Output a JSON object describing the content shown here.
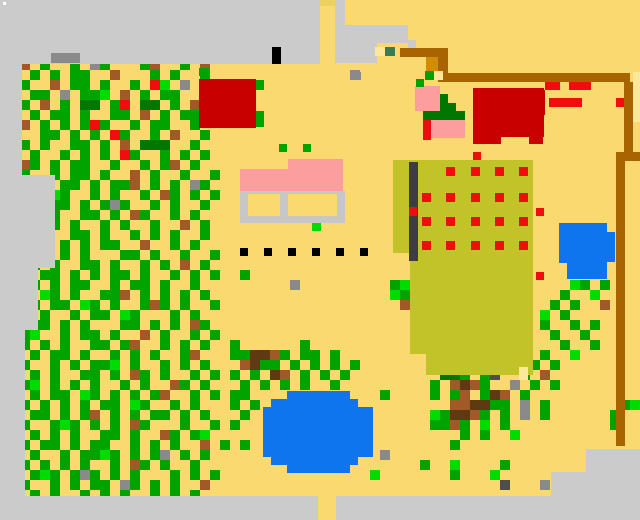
{
  "map": {
    "width": 640,
    "height": 520,
    "cell": 10,
    "cols": 64,
    "rows": 52,
    "palette": {
      ".": {
        "color": "#FBD971",
        "name": "sand-ground"
      },
      "E": {
        "color": "#CBCBCB",
        "name": "unexplored-border"
      },
      "C": {
        "color": "#C7C7C7",
        "name": "house-frame-gray"
      },
      "s": {
        "color": "#8A8A8A",
        "name": "rock-gray"
      },
      "k": {
        "color": "#4E4E4E",
        "name": "dark-rock"
      },
      "K": {
        "color": "#000000",
        "name": "black-marker"
      },
      "W": {
        "color": "#FFFFFF",
        "name": "white-dot"
      },
      "G": {
        "color": "#00A300",
        "name": "tree-green"
      },
      "g": {
        "color": "#00DC00",
        "name": "bright-green"
      },
      "D": {
        "color": "#007800",
        "name": "dark-green"
      },
      "F": {
        "color": "#3E7B50",
        "name": "muted-green"
      },
      "b": {
        "color": "#A05A28",
        "name": "dirt-brown"
      },
      "w": {
        "color": "#5E3A12",
        "name": "dark-brown"
      },
      "o": {
        "color": "#A86400",
        "name": "fence-brown"
      },
      "n": {
        "color": "#D18C00",
        "name": "orange-gate"
      },
      "O": {
        "color": "#C2C229",
        "name": "crop-field-olive"
      },
      "R": {
        "color": "#C80000",
        "name": "building-red"
      },
      "r": {
        "color": "#EF0D0D",
        "name": "bright-red"
      },
      "P": {
        "color": "#FC9E9E",
        "name": "house-pink"
      },
      "B": {
        "color": "#0F75EF",
        "name": "pond-blue"
      },
      "y": {
        "color": "#FBE89B",
        "name": "pale-sand"
      },
      "d": {
        "color": "#EDD05E",
        "name": "path-top"
      },
      "t": {
        "color": "#3E3E3E",
        "name": "slate-line"
      }
    },
    "grid": [
      "",
      "",
      "",
      "",
      "",
      "",
      "..b.G..G.sG...Gb..G.b.",
      "...G.G.GG..b...G.G..G..............s",
      "..G..b.GG.G..G.rg.s...",
      "...GG.s.GGg.b.G.GG....",
      "..G.b.G.DD.Gr.DD.G.b.G",
      "...G.GG.G..GG.b.G.GG..",
      "..b.G.G.GrG..G.GG..G..",
      "....GG.G.G.rG..G.b..G.",
      "..G.G..GG.G.b.DDD..G..",
      "...G..G.G.G.rG..G.G.G.",
      "..bG.G.GG..G..G.Gb.G..",
      "..G..G.GG.G..b.G..G..G",
      "...sG.GG.G.GGb.G.G.sG.",
      "..G.GgG..G.G..G.bG.G.G",
      "...G.GG.G.GsG..G.G..G.",
      "..G..G..GG.G.bG..G.G..",
      "...G.G.G..G.G..G..b.G.",
      "..G.b..GG.G..G.G.G..G.",
      "...G..G.G.GG..b..G.G..",
      "..G.G.G.G...GG.G..G..G",
      "...G.G..GG.G..G.G.b.G.",
      "....GG.G.G.GG.G..G.G.G..G",
      "...G.G.GG..G.GG.G..G.........s.........Gg................gG.G",
      "..G.gG.G..GGb.G.G.G.G..................gG...............G..g",
      "...G.GG.gG.G..GbG.G..G..................b..............G.G..b",
      "..G.G..G.GG.gG...G.G..................................g.G",
      "...GG.G.G...GG.G.G.bG.................................G..G.G",
      "..Gg..G.GG.G..b.G..G.G.................................G..G",
      "..G.G.G..GG.Gb..G.G.G..G......G................G..G.....G..G",
      "...G.GG.G..G.G.G..Gb...GGwwbG.GG.G...........gG..DDG..G..g",
      "..G..G.G.GGg.G..G.G.G...bwGG.G.G.G.G........GGbG..GbGG.G",
      "...G.G..GG.G.bG.G..G.G.G.G.wb.G.G.G.........DDG.Gk..G.b",
      "..Gg.G.G.G..G.G..bG.G...G.G.G.G..G.........G.bwbG..s.G.G",
      "...G.GG.gG.G.G.Gb..G.G.GG.............G....G.Gb.Gwb.G...........G",
      "..G.G.G.G.GG.gG..G.G...G.G...................bbwwGG.s.G.......Gg",
      "...GG.G.Gb.G.G.GG.G.G...G..................gGwwbG.G.s.G......G",
      "..G..GgG.G.G.bG...G..G.G...................GGbG.g.G..........G",
      "...G.G.G..GG.G..bG.Gg.........................G.G..g",
      "..G.GG.G.GG..G.G.G..b.G.G....................G",
      "...G..G.GGgG.G.Gs.G.G.................s",
      "..G.G.G.G..G.bG.G..G......................G..g....G",
      "...GgG.GsG.G.G...G.G.G...............g.......G...g",
      "..G..G.G.GG.sG.G.G..b.............................k...s",
      "...G.G..G.G.G..G.G.G..",
      "",
      ""
    ],
    "rects": [
      [
        0,
        0,
        320,
        64,
        "E"
      ],
      [
        320,
        0,
        17,
        6,
        "d"
      ],
      [
        335,
        0,
        10,
        31,
        "E"
      ],
      [
        335,
        25,
        42,
        38,
        "E"
      ],
      [
        377,
        25,
        31,
        18,
        "E"
      ],
      [
        408,
        40,
        8,
        8,
        "E"
      ],
      [
        0,
        64,
        22,
        432,
        "E"
      ],
      [
        0,
        175,
        55,
        93,
        "E"
      ],
      [
        0,
        268,
        38,
        62,
        "E"
      ],
      [
        0,
        330,
        25,
        166,
        "E"
      ],
      [
        586,
        449,
        54,
        47,
        "E"
      ],
      [
        551,
        472,
        89,
        24,
        "E"
      ],
      [
        0,
        496,
        640,
        24,
        "E"
      ],
      [
        318,
        496,
        18,
        24,
        "."
      ],
      [
        3,
        2,
        3,
        3,
        "W"
      ],
      [
        51,
        53,
        29,
        10,
        "s"
      ],
      [
        272,
        47,
        9,
        17,
        "K"
      ],
      [
        351,
        72,
        10,
        8,
        "s"
      ],
      [
        375,
        47,
        10,
        9,
        "y"
      ],
      [
        385,
        47,
        10,
        9,
        "F"
      ],
      [
        633,
        72,
        7,
        50,
        "y"
      ],
      [
        393,
        160,
        17,
        93,
        "O"
      ],
      [
        410,
        160,
        16,
        194,
        "O"
      ],
      [
        426,
        160,
        107,
        215,
        "O"
      ],
      [
        409,
        162,
        9,
        99,
        "t"
      ],
      [
        409,
        207,
        8,
        9,
        "r"
      ],
      [
        519,
        367,
        9,
        13,
        "y"
      ],
      [
        446,
        167,
        9,
        9,
        "r"
      ],
      [
        471,
        167,
        9,
        9,
        "r"
      ],
      [
        495,
        167,
        9,
        9,
        "r"
      ],
      [
        519,
        167,
        9,
        9,
        "r"
      ],
      [
        422,
        193,
        9,
        9,
        "r"
      ],
      [
        446,
        193,
        9,
        9,
        "r"
      ],
      [
        471,
        193,
        9,
        9,
        "r"
      ],
      [
        495,
        193,
        9,
        9,
        "r"
      ],
      [
        519,
        193,
        9,
        9,
        "r"
      ],
      [
        422,
        217,
        9,
        9,
        "r"
      ],
      [
        446,
        217,
        9,
        9,
        "r"
      ],
      [
        471,
        217,
        9,
        9,
        "r"
      ],
      [
        495,
        217,
        9,
        9,
        "r"
      ],
      [
        519,
        217,
        9,
        9,
        "r"
      ],
      [
        422,
        241,
        9,
        9,
        "r"
      ],
      [
        446,
        241,
        9,
        9,
        "r"
      ],
      [
        471,
        241,
        9,
        9,
        "r"
      ],
      [
        495,
        241,
        9,
        9,
        "r"
      ],
      [
        519,
        241,
        9,
        9,
        "r"
      ],
      [
        400,
        48,
        48,
        9,
        "o"
      ],
      [
        438,
        57,
        10,
        25,
        "o"
      ],
      [
        426,
        57,
        12,
        14,
        "n"
      ],
      [
        425,
        71,
        9,
        9,
        "G"
      ],
      [
        434,
        71,
        9,
        9,
        "y"
      ],
      [
        444,
        73,
        186,
        9,
        "o"
      ],
      [
        624,
        82,
        9,
        70,
        "o"
      ],
      [
        616,
        152,
        24,
        9,
        "o"
      ],
      [
        616,
        161,
        9,
        285,
        "o"
      ],
      [
        199,
        79,
        57,
        49,
        "R"
      ],
      [
        199,
        68,
        10,
        8,
        "G"
      ],
      [
        256,
        80,
        8,
        10,
        "G"
      ],
      [
        256,
        111,
        8,
        16,
        "G"
      ],
      [
        473,
        88,
        71,
        49,
        "R"
      ],
      [
        473,
        136,
        28,
        8,
        "R"
      ],
      [
        529,
        136,
        14,
        8,
        "R"
      ],
      [
        540,
        90,
        5,
        25,
        "R"
      ],
      [
        545,
        82,
        15,
        8,
        "r"
      ],
      [
        569,
        82,
        22,
        8,
        "r"
      ],
      [
        549,
        98,
        33,
        9,
        "r"
      ],
      [
        616,
        98,
        8,
        9,
        "r"
      ],
      [
        473,
        152,
        8,
        8,
        "r"
      ],
      [
        536,
        208,
        8,
        8,
        "r"
      ],
      [
        536,
        272,
        8,
        8,
        "r"
      ],
      [
        415,
        86,
        25,
        25,
        "P"
      ],
      [
        440,
        94,
        8,
        9,
        "D"
      ],
      [
        440,
        103,
        16,
        8,
        "D"
      ],
      [
        423,
        111,
        42,
        9,
        "D"
      ],
      [
        431,
        120,
        34,
        18,
        "P"
      ],
      [
        423,
        120,
        8,
        20,
        "r"
      ],
      [
        416,
        79,
        8,
        8,
        "G"
      ],
      [
        288,
        159,
        55,
        11,
        "P"
      ],
      [
        240,
        169,
        103,
        22,
        "P"
      ],
      [
        240,
        191,
        105,
        32,
        "C"
      ],
      [
        248,
        194,
        32,
        22,
        "."
      ],
      [
        288,
        194,
        49,
        22,
        "."
      ],
      [
        279,
        144,
        8,
        8,
        "G"
      ],
      [
        303,
        144,
        8,
        8,
        "G"
      ],
      [
        312,
        223,
        9,
        8,
        "g"
      ],
      [
        240,
        248,
        8,
        8,
        "K"
      ],
      [
        264,
        248,
        8,
        8,
        "K"
      ],
      [
        288,
        248,
        8,
        8,
        "K"
      ],
      [
        312,
        248,
        8,
        8,
        "K"
      ],
      [
        336,
        248,
        8,
        8,
        "K"
      ],
      [
        360,
        248,
        8,
        8,
        "K"
      ],
      [
        559,
        223,
        48,
        40,
        "B"
      ],
      [
        599,
        232,
        16,
        30,
        "B"
      ],
      [
        567,
        255,
        40,
        24,
        "B"
      ],
      [
        287,
        391,
        63,
        82,
        "B"
      ],
      [
        271,
        399,
        87,
        66,
        "B"
      ],
      [
        263,
        407,
        110,
        50,
        "B"
      ]
    ]
  }
}
